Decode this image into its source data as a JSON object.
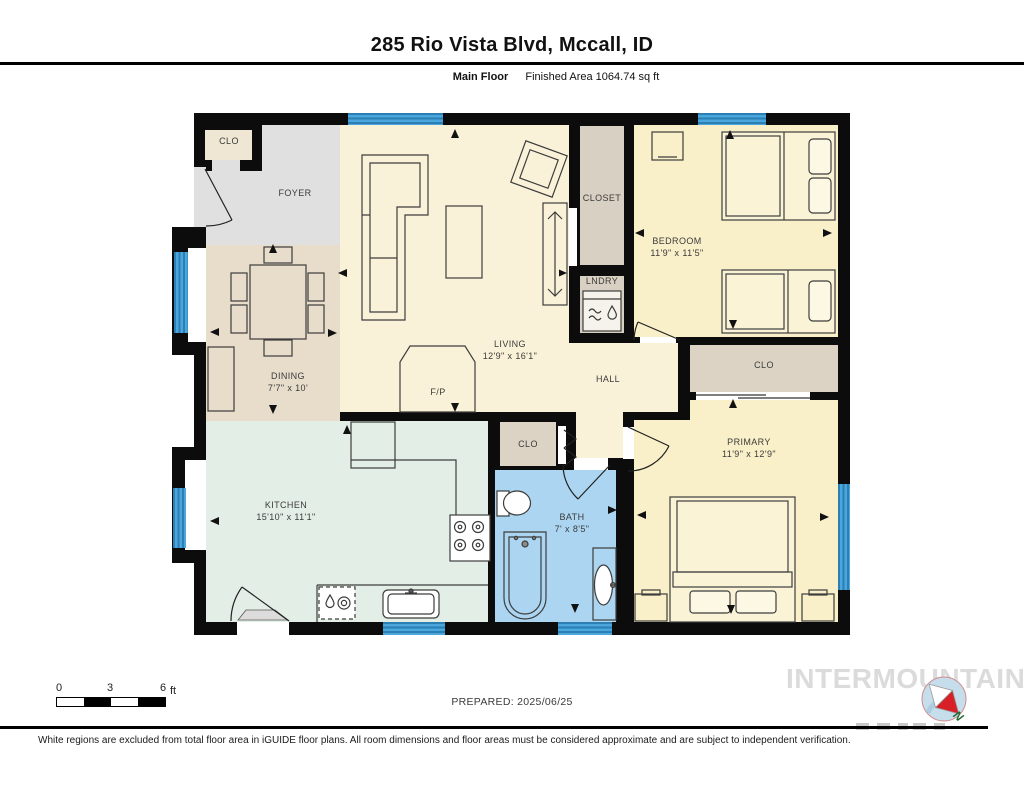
{
  "header": {
    "title": "285 Rio Vista Blvd, Mccall, ID",
    "floor_label": "Main Floor",
    "area_label": "Finished Area 1064.74 sq ft"
  },
  "rooms": {
    "clo_entry": {
      "name": "CLO"
    },
    "foyer": {
      "name": "FOYER"
    },
    "dining": {
      "name": "DINING",
      "dims": "7'7\" x 10'"
    },
    "living": {
      "name": "LIVING",
      "dims": "12'9\" x 16'1\""
    },
    "fireplace": {
      "name": "F/P"
    },
    "closet": {
      "name": "CLOSET"
    },
    "laundry": {
      "name": "LNDRY"
    },
    "bedroom": {
      "name": "BEDROOM",
      "dims": "11'9\" x 11'5\""
    },
    "clo_primary": {
      "name": "CLO"
    },
    "hall": {
      "name": "HALL"
    },
    "primary": {
      "name": "PRIMARY",
      "dims": "11'9\" x 12'9\""
    },
    "clo_hall": {
      "name": "CLO"
    },
    "bath": {
      "name": "BATH",
      "dims": "7' x 8'5\""
    },
    "kitchen": {
      "name": "KITCHEN",
      "dims": "15'10\" x 11'1\""
    }
  },
  "scale_bar": {
    "tick0": "0",
    "tick1": "3",
    "tick2": "6",
    "unit": "ft"
  },
  "prepared": "PREPARED: 2025/06/25",
  "watermark": "INTERMOUNTAIN",
  "compass": {
    "north_label": "N"
  },
  "footer": {
    "disclaimer": "White regions are excluded from total floor area in iGUIDE floor plans. All room dimensions and floor areas must be considered approximate and are subject to independent verification."
  },
  "colors": {
    "wall": "#0c0c0c",
    "window": "#4aa6dc",
    "living_cream": "#faf2d8",
    "bedroom_yellow": "#f9efc9",
    "dining_tan": "#e7ddca",
    "foyer_gray": "#e0e0e0",
    "kitchen_mint": "#e3efe6",
    "bath_blue": "#abd5f0",
    "closet_tan": "#d8d0c2"
  }
}
